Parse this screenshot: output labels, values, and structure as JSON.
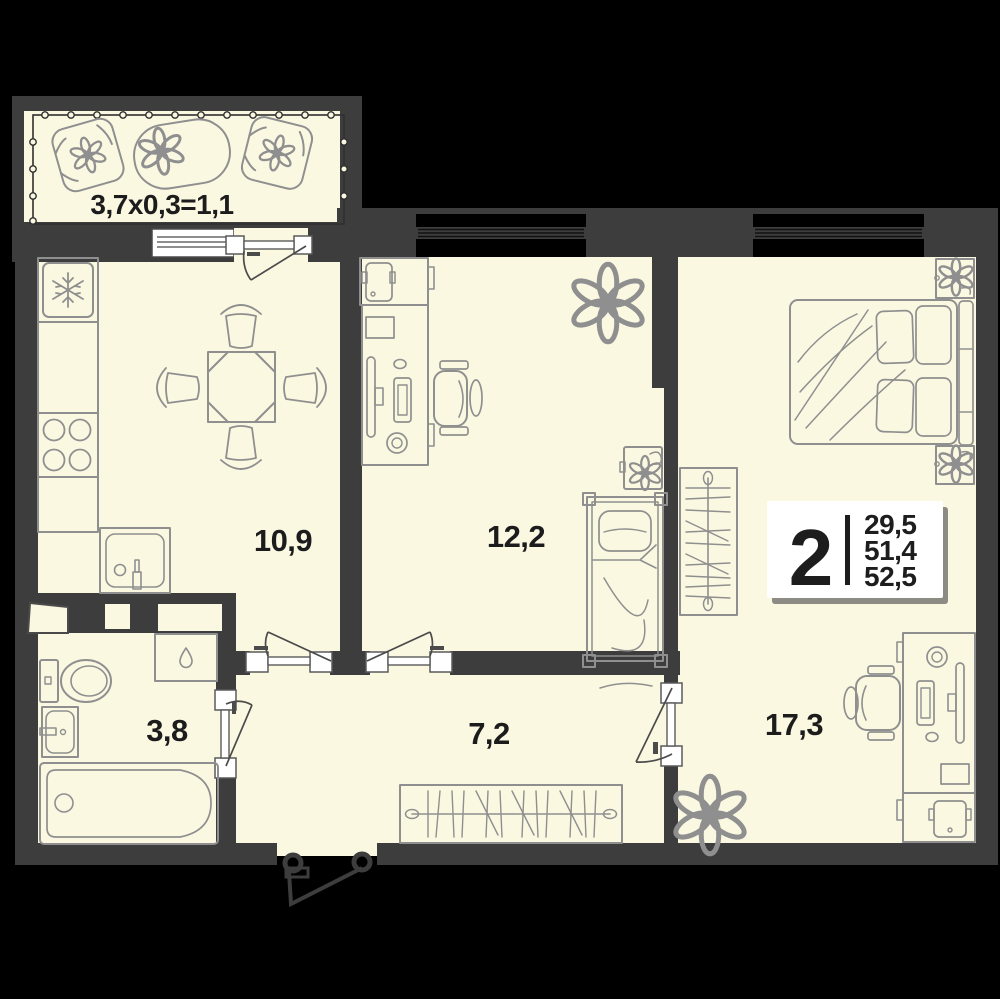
{
  "colors": {
    "background": "#000000",
    "walls": "#3d3d3d",
    "floor": "#fbf8e2",
    "furniture_stroke": "#8f8f8f",
    "label_text": "#1c1c1c",
    "badge_bg": "#ffffff",
    "badge_text": "#1d1d1d",
    "badge_shadow": "#8c8c84"
  },
  "balcony": {
    "label": "3,7x0,3=1,1"
  },
  "rooms": {
    "kitchen": {
      "area": "10,9"
    },
    "living": {
      "area": "12,2"
    },
    "bathroom": {
      "area": "3,8"
    },
    "hallway": {
      "area": "7,2"
    },
    "bedroom": {
      "area": "17,3"
    }
  },
  "badge": {
    "rooms_count": "2",
    "areas": [
      "29,5",
      "51,4",
      "52,5"
    ]
  }
}
